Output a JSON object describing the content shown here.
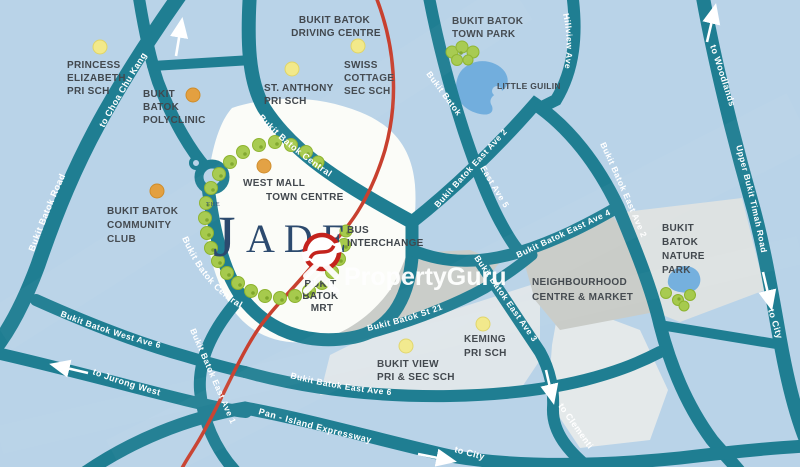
{
  "watermark": {
    "brand": "PropertyGuru"
  },
  "development": {
    "the": "THE",
    "name_initial": "J",
    "name_rest": "ADE"
  },
  "places": {
    "princess_elizabeth": [
      "PRINCESS",
      "ELIZABETH",
      "PRI SCH"
    ],
    "bukit_batok_polyclinic": [
      "BUKIT",
      "BATOK",
      "POLYCLINIC"
    ],
    "driving_centre": [
      "BUKIT BATOK",
      "DRIVING CENTRE"
    ],
    "st_anthony": [
      "ST. ANTHONY",
      "PRI SCH"
    ],
    "swiss_cottage": [
      "SWISS",
      "COTTAGE",
      "SEC SCH"
    ],
    "town_park": [
      "BUKIT BATOK",
      "TOWN PARK"
    ],
    "little_guilin": "LITTLE GUILIN",
    "west_mall": "WEST MALL",
    "town_centre": "TOWN CENTRE",
    "community_club": [
      "BUKIT BATOK",
      "COMMUNITY",
      "CLUB"
    ],
    "bus_interchange": [
      "BUS",
      "INTERCHANGE"
    ],
    "mrt_station": [
      "BUKIT",
      "BATOK",
      "MRT"
    ],
    "neighbourhood_centre": [
      "NEIGHBOURHOOD",
      "CENTRE & MARKET"
    ],
    "nature_park": [
      "BUKIT",
      "BATOK",
      "NATURE",
      "PARK"
    ],
    "keming": [
      "KEMING",
      "PRI SCH"
    ],
    "bukit_view": [
      "BUKIT VIEW",
      "PRI & SEC SCH"
    ]
  },
  "roads": {
    "bukit_batok_road": "Bukit Batok Road",
    "central": "Bukit Batok Central",
    "east_ave_1": "Bukit Batok East Ave 1",
    "east_ave_2": "Bukit Batok East Ave 2",
    "bukit_batok_part": "Bukit Batok",
    "east_ave_5_part": "East Ave 5",
    "east_ave_3": "Bukit Batok East Ave 3",
    "east_ave_4": "Bukit Batok East Ave 4",
    "east_ave_6": "Bukit Batok East Ave 6",
    "west_ave_6": "Bukit Batok West Ave 6",
    "st_21": "Bukit Batok St 21",
    "pie": "Pan - Island Expressway",
    "hillview_ave": "Hillview Ave",
    "upper_bukit_timah": "Upper Bukit Timah Road"
  },
  "directions": {
    "choa_chu_kang": "to Choa Chu Kang",
    "woodlands": "to Woodlands",
    "city": "to City",
    "clementi": "to Clementi",
    "jurong_west": "to Jurong West"
  },
  "colors": {
    "road": "#1f7e92",
    "background": "#b9d3e8",
    "rail_line": "#c8402f",
    "white_area": "#fbfcf8",
    "gray_area": "#c9ccc8",
    "pale_area": "#e2e8ea",
    "lake": "#72aedd",
    "tree": "#a6ca4d",
    "school_dot": "#f2e98a",
    "amenity_dot": "#e3a040",
    "label_text": "#42484e",
    "logo_navy": "#2c4a6e",
    "mrt_red": "#c4231d"
  }
}
